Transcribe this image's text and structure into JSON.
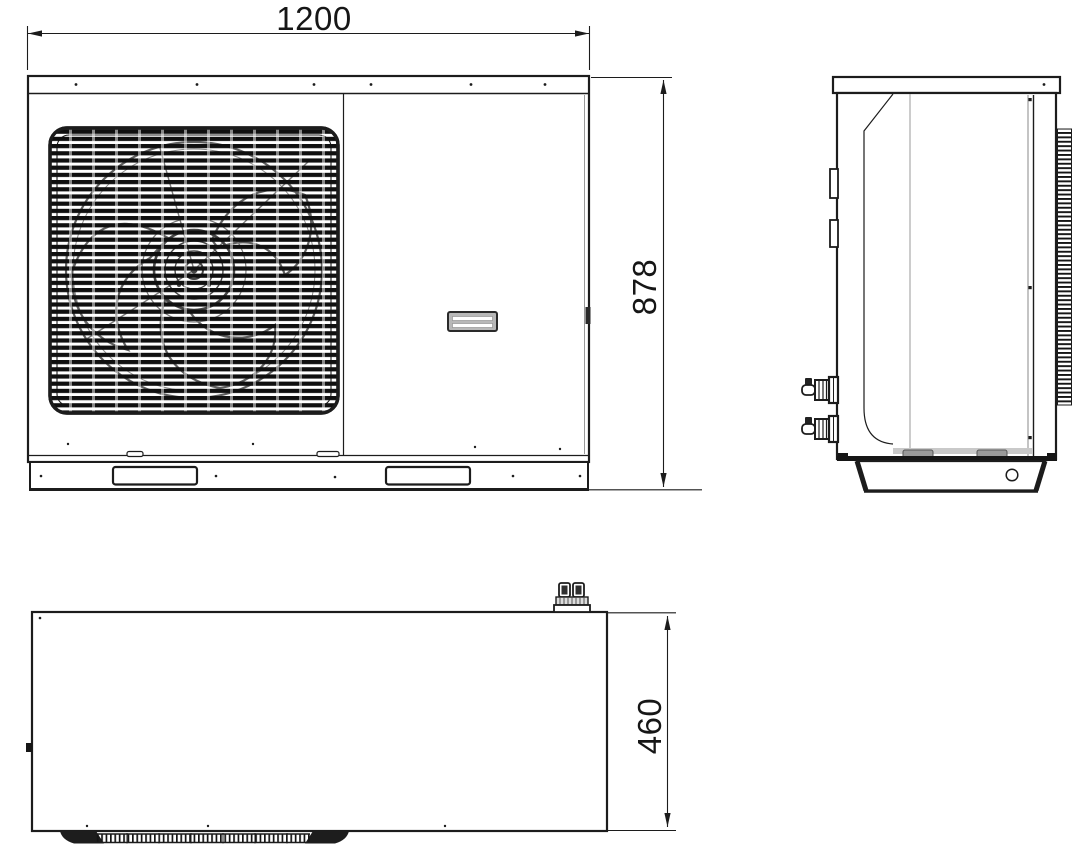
{
  "drawing": {
    "description": "dimensional line drawing of a monobloc outdoor unit (front, side and top views)",
    "colors": {
      "line": "#1c1c1c",
      "fan": "#5f5f5f",
      "handle_fill": "#b8b8b8"
    },
    "dimensions": {
      "width_mm": "1200",
      "height_mm": "878",
      "depth_mm": "460"
    }
  }
}
